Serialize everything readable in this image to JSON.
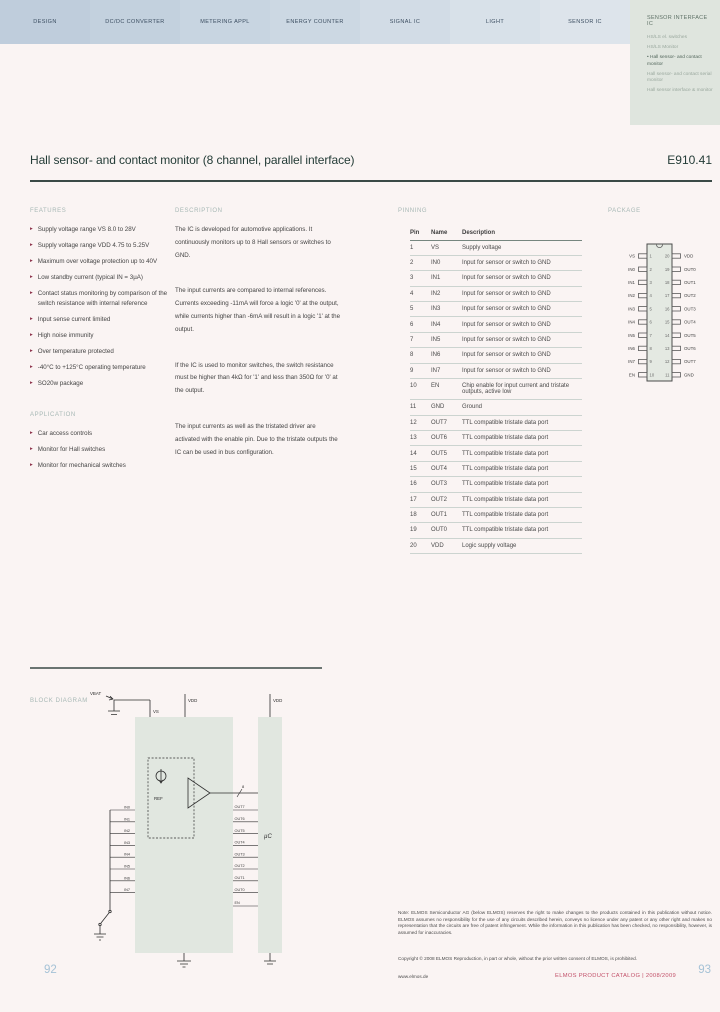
{
  "icons": {
    "bullet": "▸"
  },
  "colors": {
    "accent_red": "#c25069",
    "page_number_blue": "#a5c2d6",
    "sidebar_green": "#dfe5de",
    "bullet_maroon": "#8c3049",
    "chip_fill": "#e1e7e0"
  },
  "nav": {
    "tabs": [
      {
        "label": "DESIGN",
        "bg": "#bfcddc"
      },
      {
        "label": "DC/DC CONVERTER",
        "bg": "#c3d1de"
      },
      {
        "label": "METERING APPL",
        "bg": "#c8d5e1"
      },
      {
        "label": "ENERGY COUNTER",
        "bg": "#ccd8e3"
      },
      {
        "label": "SIGNAL IC",
        "bg": "#d2dce6"
      },
      {
        "label": "LIGHT",
        "bg": "#d8e1e9"
      },
      {
        "label": "SENSOR IC",
        "bg": "#dde4eb"
      }
    ],
    "sidebar": {
      "title": "SENSOR INTERFACE IC",
      "items": [
        {
          "label": "HS/LS el. switches",
          "active": false
        },
        {
          "label": "HS/LS Monitor",
          "active": false
        },
        {
          "label": "Hall sensor- and contact monitor",
          "active": true
        },
        {
          "label": "Hall sensor- and contact serial monitor",
          "active": false
        },
        {
          "label": "Hall sensor interface & monitor",
          "active": false
        }
      ]
    }
  },
  "header": {
    "title": "Hall sensor- and contact monitor (8 channel, parallel interface)",
    "part_number": "E910.41"
  },
  "features": {
    "heading": "FEATURES",
    "items": [
      "Supply voltage range VS 8.0 to 28V",
      "Supply voltage range VDD 4.75 to 5.25V",
      "Maximum over voltage protection up to 40V",
      "Low standby current (typical IN = 3µA)",
      "Contact status monitoring by comparison of the switch resistance with internal reference",
      "Input sense current limited",
      "High noise immunity",
      "Over temperature protected",
      "-40°C to +125°C operating temperature",
      "SO20w package"
    ]
  },
  "applications": {
    "heading": "APPLICATION",
    "items": [
      "Car access controls",
      "Monitor for Hall switches",
      "Monitor for mechanical switches"
    ]
  },
  "description": {
    "heading": "DESCRIPTION",
    "paragraphs": [
      "The IC is developed for automotive applications. It continuously monitors up to 8 Hall sensors or switches to GND.",
      "The input currents are compared to internal references. Currents exceeding -11mA will force a logic '0' at the output, while currents higher than -6mA will result in a logic '1' at the output.",
      "If the IC is used to monitor switches, the switch resistance must be higher than 4kΩ for '1' and less than 350Ω for '0' at the output.",
      "The input currents as well as the tristated driver are activated with the enable pin. Due to the tristate outputs the IC can be used in bus configuration."
    ]
  },
  "pinning": {
    "heading": "PINNING",
    "columns": [
      "Pin",
      "Name",
      "Description"
    ],
    "rows": [
      [
        "1",
        "VS",
        "Supply voltage"
      ],
      [
        "2",
        "IN0",
        "Input for sensor or switch to GND"
      ],
      [
        "3",
        "IN1",
        "Input for sensor or switch to GND"
      ],
      [
        "4",
        "IN2",
        "Input for sensor or switch to GND"
      ],
      [
        "5",
        "IN3",
        "Input for sensor or switch to GND"
      ],
      [
        "6",
        "IN4",
        "Input for sensor or switch to GND"
      ],
      [
        "7",
        "IN5",
        "Input for sensor or switch to GND"
      ],
      [
        "8",
        "IN6",
        "Input for sensor or switch to GND"
      ],
      [
        "9",
        "IN7",
        "Input for sensor or switch to GND"
      ],
      [
        "10",
        "EN",
        "Chip enable for input current and tristate outputs, active low"
      ],
      [
        "11",
        "GND",
        "Ground"
      ],
      [
        "12",
        "OUT7",
        "TTL compatible tristate data port"
      ],
      [
        "13",
        "OUT6",
        "TTL compatible tristate data port"
      ],
      [
        "14",
        "OUT5",
        "TTL compatible tristate data port"
      ],
      [
        "15",
        "OUT4",
        "TTL compatible tristate data port"
      ],
      [
        "16",
        "OUT3",
        "TTL compatible tristate data port"
      ],
      [
        "17",
        "OUT2",
        "TTL compatible tristate data port"
      ],
      [
        "18",
        "OUT1",
        "TTL compatible tristate data port"
      ],
      [
        "19",
        "OUT0",
        "TTL compatible tristate data port"
      ],
      [
        "20",
        "VDD",
        "Logic supply voltage"
      ]
    ]
  },
  "package": {
    "heading": "PACKAGE",
    "left_pins": [
      {
        "num": "1",
        "name": "VS"
      },
      {
        "num": "2",
        "name": "IN0"
      },
      {
        "num": "3",
        "name": "IN1"
      },
      {
        "num": "4",
        "name": "IN2"
      },
      {
        "num": "5",
        "name": "IN3"
      },
      {
        "num": "6",
        "name": "IN4"
      },
      {
        "num": "7",
        "name": "IN5"
      },
      {
        "num": "8",
        "name": "IN6"
      },
      {
        "num": "9",
        "name": "IN7"
      },
      {
        "num": "10",
        "name": "EN"
      }
    ],
    "right_pins": [
      {
        "num": "20",
        "name": "VDD"
      },
      {
        "num": "19",
        "name": "OUT0"
      },
      {
        "num": "18",
        "name": "OUT1"
      },
      {
        "num": "17",
        "name": "OUT2"
      },
      {
        "num": "16",
        "name": "OUT3"
      },
      {
        "num": "15",
        "name": "OUT4"
      },
      {
        "num": "14",
        "name": "OUT5"
      },
      {
        "num": "13",
        "name": "OUT6"
      },
      {
        "num": "12",
        "name": "OUT7"
      },
      {
        "num": "11",
        "name": "GND"
      }
    ]
  },
  "block_diagram": {
    "heading": "BLOCK DIAGRAM",
    "labels": {
      "vbat": "VBAT",
      "vs": "VS",
      "vdd": "VDD",
      "vdd_mcu": "VDD",
      "ref": "REF",
      "bus": "8",
      "en": "EN",
      "mcu": "µC"
    },
    "inputs": [
      "IN0",
      "IN1",
      "IN2",
      "IN3",
      "IN4",
      "IN5",
      "IN6",
      "IN7"
    ],
    "outputs": [
      "OUT7",
      "OUT6",
      "OUT5",
      "OUT4",
      "OUT3",
      "OUT2",
      "OUT1",
      "OUT0"
    ]
  },
  "footer": {
    "disclaimer": "Note: ELMOS Semiconductor AG (below ELMOS) reserves the right to make changes to the products contained in this publication without notice. ELMOS assumes no responsibility for the use of any circuits described herein, conveys no licence under any patent or any other right and makes no representation that the circuits are free of patent infringement. While the information in this publication has been checked, no responsibility, however, is assumed for inaccuracies.",
    "copyright": "Copyright © 2008 ELMOS Reproduction, in part or whole, without the prior written consent of ELMOS, is prohibited.",
    "website": "www.elmos.de",
    "catalog": "ELMOS PRODUCT CATALOG | 2008/2009",
    "page_left": "92",
    "page_right": "93"
  }
}
